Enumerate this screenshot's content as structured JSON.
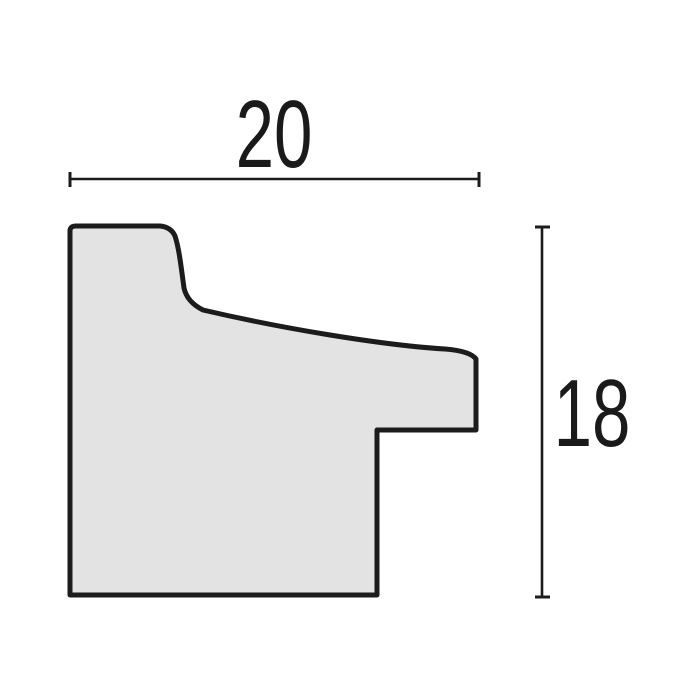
{
  "diagram": {
    "type": "moulding-profile-cross-section",
    "description": "Technical drawing of a frame moulding profile with overall width and height dimensions",
    "dimensions": {
      "width": {
        "value": "20"
      },
      "height": {
        "value": "18"
      }
    },
    "colors": {
      "profile_fill": "#e3e3e3",
      "outline": "#1c1c1c",
      "dimension_lines": "#1c1c1c",
      "label_text": "#1a1a1a",
      "background": "#ffffff"
    }
  }
}
